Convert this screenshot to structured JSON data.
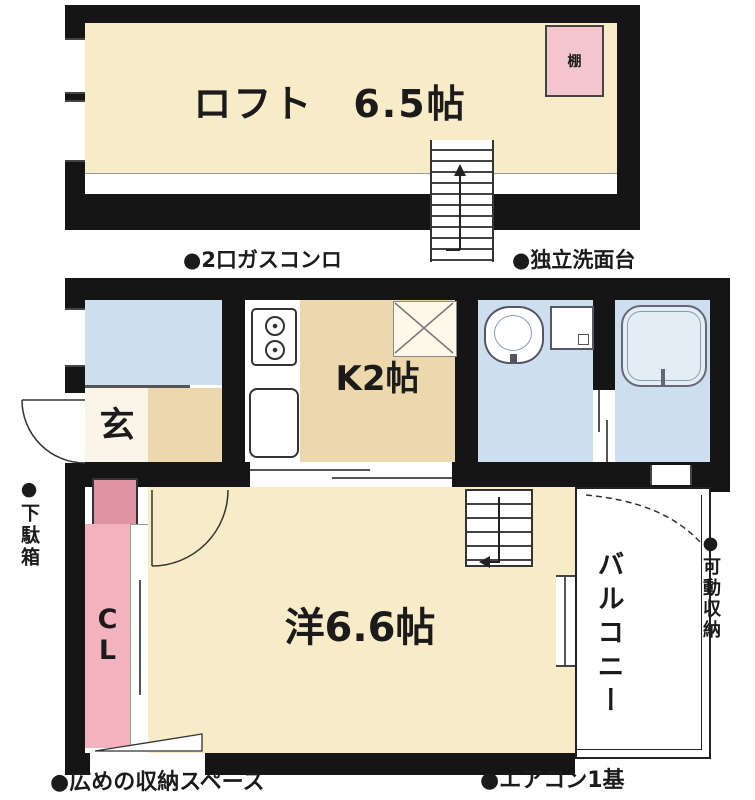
{
  "loft": {
    "label": "ロフト　6.5帖",
    "shelf": "棚"
  },
  "rooms": {
    "entrance": "玄",
    "kitchen": "K2帖",
    "living": "洋6.6帖",
    "closet": "CL",
    "balcony": "バルコニー"
  },
  "annotations": {
    "gas_stove": "●2口ガスコンロ",
    "vanity": "●独立洗面台",
    "shoe_box": "●下駄箱",
    "movable_storage": "●可動収納",
    "wide_storage": "●広めの収納スペース",
    "aircon": "●エアコン1基"
  },
  "colors": {
    "wall": "#151515",
    "cream": "#F8EBC8",
    "tan": "#EDD7AC",
    "water_blue": "#CDDFEF",
    "closet_pink": "#F2B3BE",
    "shoe_pink": "#DE95A1",
    "shelf_pink": "#F3C6CE"
  }
}
